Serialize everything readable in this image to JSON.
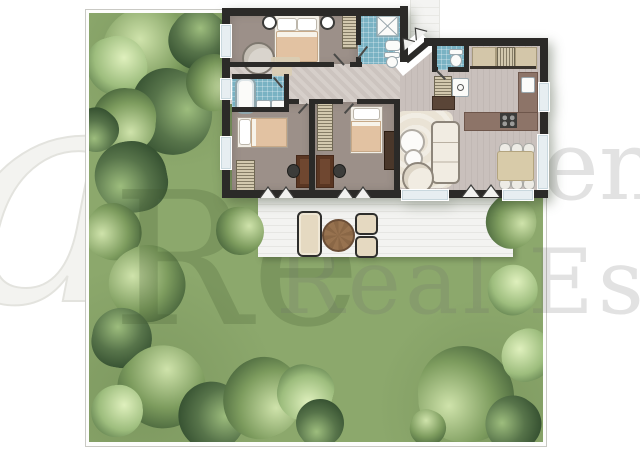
{
  "scene": {
    "type": "real-estate floor plan top view with garden, terrace and trees",
    "rooms": [
      "master-bedroom",
      "bathroom-shower",
      "hallway",
      "bathroom-tub",
      "bedroom-2",
      "bedroom-3",
      "living-room",
      "kitchen",
      "dining-area",
      "wc",
      "entry",
      "terrace",
      "garden"
    ]
  },
  "watermark": {
    "script_glyph": "a",
    "monogram": "Re",
    "fragment_line1": "en",
    "fragment_line2": "Real Estat"
  },
  "palette": {
    "lawn": "#8ca86c",
    "wall": "#2b2a28",
    "taupe_floor": "#9c9089",
    "plank_floor": "#c8bfbc",
    "hall_floor": "#d2cbc6",
    "tile_blue": "#79b2c3",
    "terrace": "#f2f2f0",
    "counter": "#8d7468",
    "wood": "#6f4730",
    "blanket": "#e2c2a2",
    "outdoor_table": "#97724f",
    "tree_dark": "#2f4a2c",
    "tree_mid": "#57744a",
    "tree_light": "#9dbd7d",
    "tree_pale": "#cfe3ab"
  },
  "garden": {
    "trees": [
      {
        "x": 152,
        "y": 57,
        "r": 50,
        "tone": "mid"
      },
      {
        "x": 199,
        "y": 40,
        "r": 30,
        "tone": "dark"
      },
      {
        "x": 117,
        "y": 66,
        "r": 30,
        "tone": "light"
      },
      {
        "x": 171,
        "y": 112,
        "r": 42,
        "tone": "dark"
      },
      {
        "x": 214,
        "y": 82,
        "r": 28,
        "tone": "mid"
      },
      {
        "x": 124,
        "y": 120,
        "r": 32,
        "tone": "mid"
      },
      {
        "x": 96,
        "y": 130,
        "r": 22,
        "tone": "dark"
      },
      {
        "x": 131,
        "y": 177,
        "r": 36,
        "tone": "dark"
      },
      {
        "x": 114,
        "y": 232,
        "r": 28,
        "tone": "mid"
      },
      {
        "x": 147,
        "y": 284,
        "r": 38,
        "tone": "mid"
      },
      {
        "x": 122,
        "y": 338,
        "r": 30,
        "tone": "dark"
      },
      {
        "x": 163,
        "y": 387,
        "r": 42,
        "tone": "mid"
      },
      {
        "x": 117,
        "y": 411,
        "r": 26,
        "tone": "light"
      },
      {
        "x": 212,
        "y": 416,
        "r": 34,
        "tone": "dark"
      },
      {
        "x": 262,
        "y": 398,
        "r": 40,
        "tone": "mid"
      },
      {
        "x": 305,
        "y": 393,
        "r": 28,
        "tone": "light"
      },
      {
        "x": 320,
        "y": 423,
        "r": 24,
        "tone": "dark"
      },
      {
        "x": 466,
        "y": 394,
        "r": 48,
        "tone": "mid"
      },
      {
        "x": 513,
        "y": 424,
        "r": 28,
        "tone": "dark"
      },
      {
        "x": 527,
        "y": 355,
        "r": 26,
        "tone": "light"
      },
      {
        "x": 428,
        "y": 428,
        "r": 18,
        "tone": "mid"
      },
      {
        "x": 513,
        "y": 290,
        "r": 25,
        "tone": "light"
      },
      {
        "x": 240,
        "y": 231,
        "r": 24,
        "tone": "mid",
        "z": 5
      },
      {
        "x": 511,
        "y": 222,
        "r": 26,
        "tone": "mid",
        "z": 5
      }
    ]
  }
}
